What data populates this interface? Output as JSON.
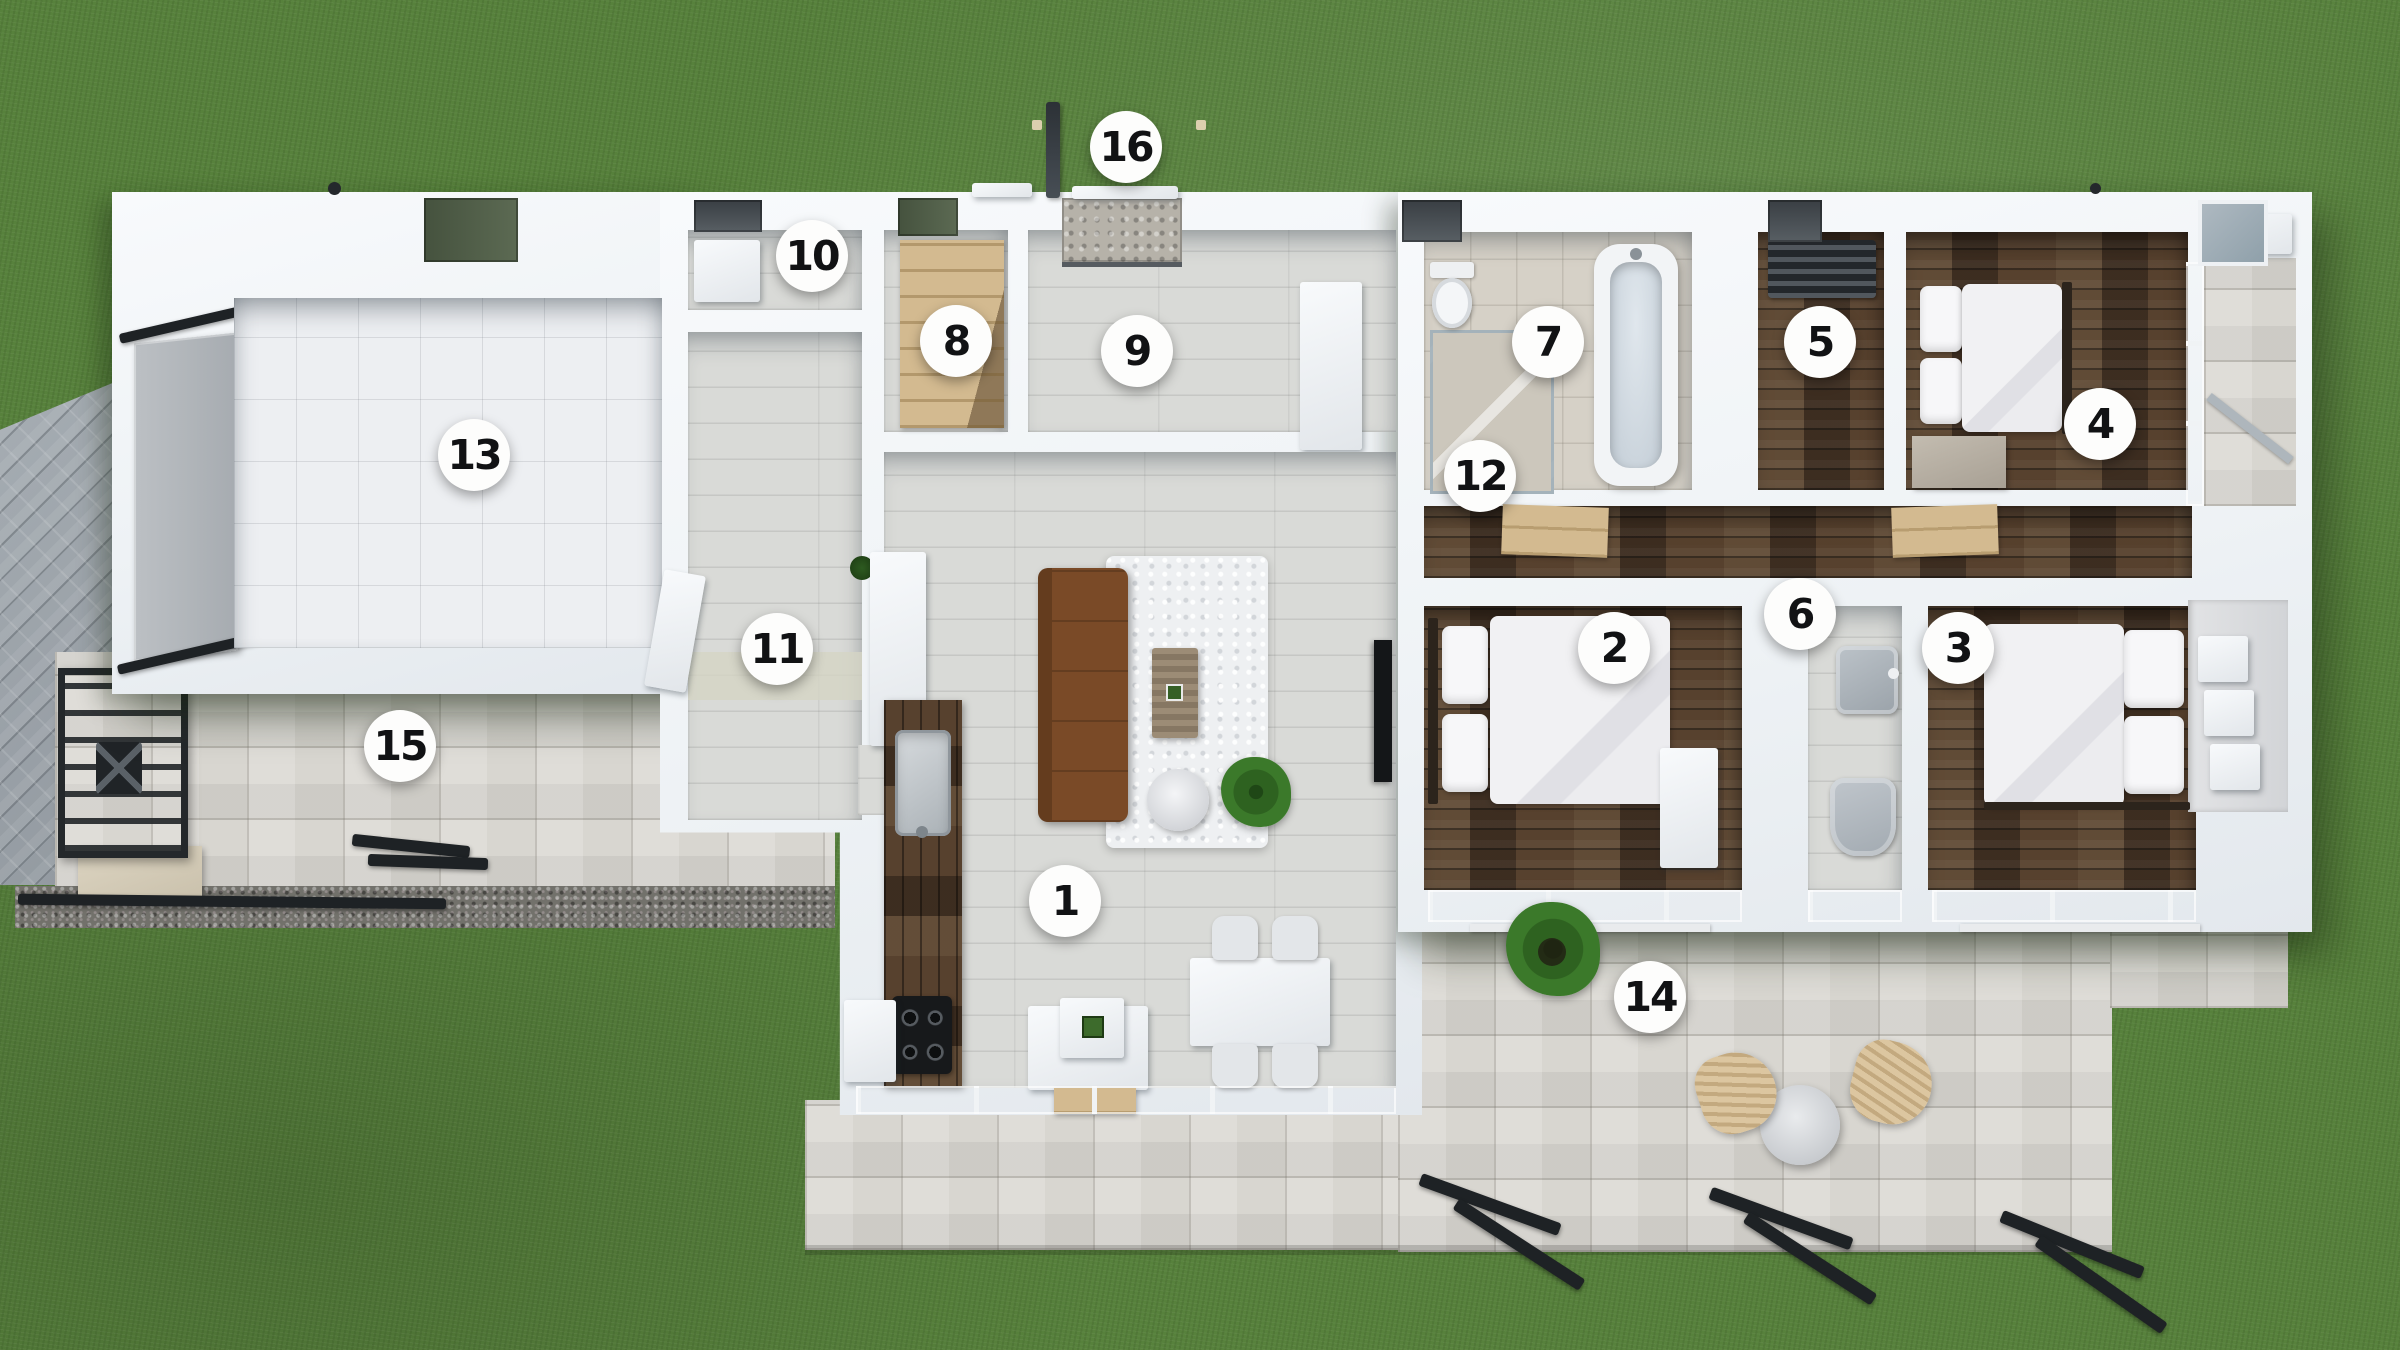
{
  "scene": {
    "kind": "3d-floor-plan-top-view",
    "marker_count": 16
  },
  "markers": [
    {
      "label": "1",
      "x": 1065,
      "y": 901
    },
    {
      "label": "2",
      "x": 1614,
      "y": 648
    },
    {
      "label": "3",
      "x": 1958,
      "y": 648
    },
    {
      "label": "4",
      "x": 2100,
      "y": 424
    },
    {
      "label": "5",
      "x": 1820,
      "y": 342
    },
    {
      "label": "6",
      "x": 1800,
      "y": 614
    },
    {
      "label": "7",
      "x": 1548,
      "y": 342
    },
    {
      "label": "8",
      "x": 956,
      "y": 341
    },
    {
      "label": "9",
      "x": 1137,
      "y": 351
    },
    {
      "label": "10",
      "x": 812,
      "y": 256
    },
    {
      "label": "11",
      "x": 777,
      "y": 649
    },
    {
      "label": "12",
      "x": 1480,
      "y": 476
    },
    {
      "label": "13",
      "x": 474,
      "y": 455
    },
    {
      "label": "14",
      "x": 1650,
      "y": 997
    },
    {
      "label": "15",
      "x": 400,
      "y": 746
    },
    {
      "label": "16",
      "x": 1126,
      "y": 147
    }
  ],
  "colors": {
    "grass": "#57813c",
    "pavers": "#9aa1a8",
    "stone": "#d8d6d0",
    "gravel": "#72716b",
    "wall": "#f1f4f7",
    "garage_floor": "#edeff2",
    "tile_floor": "#d9dad7",
    "bath_floor": "#d6d1c7",
    "wood_dark": "#4a3829",
    "wood_light": "#d3ba90",
    "sofa": "#7a4a27",
    "glass": "#c9d0d6",
    "black_steel": "#26292d",
    "marker_bg": "#fdfdfc",
    "marker_text": "#111214"
  }
}
